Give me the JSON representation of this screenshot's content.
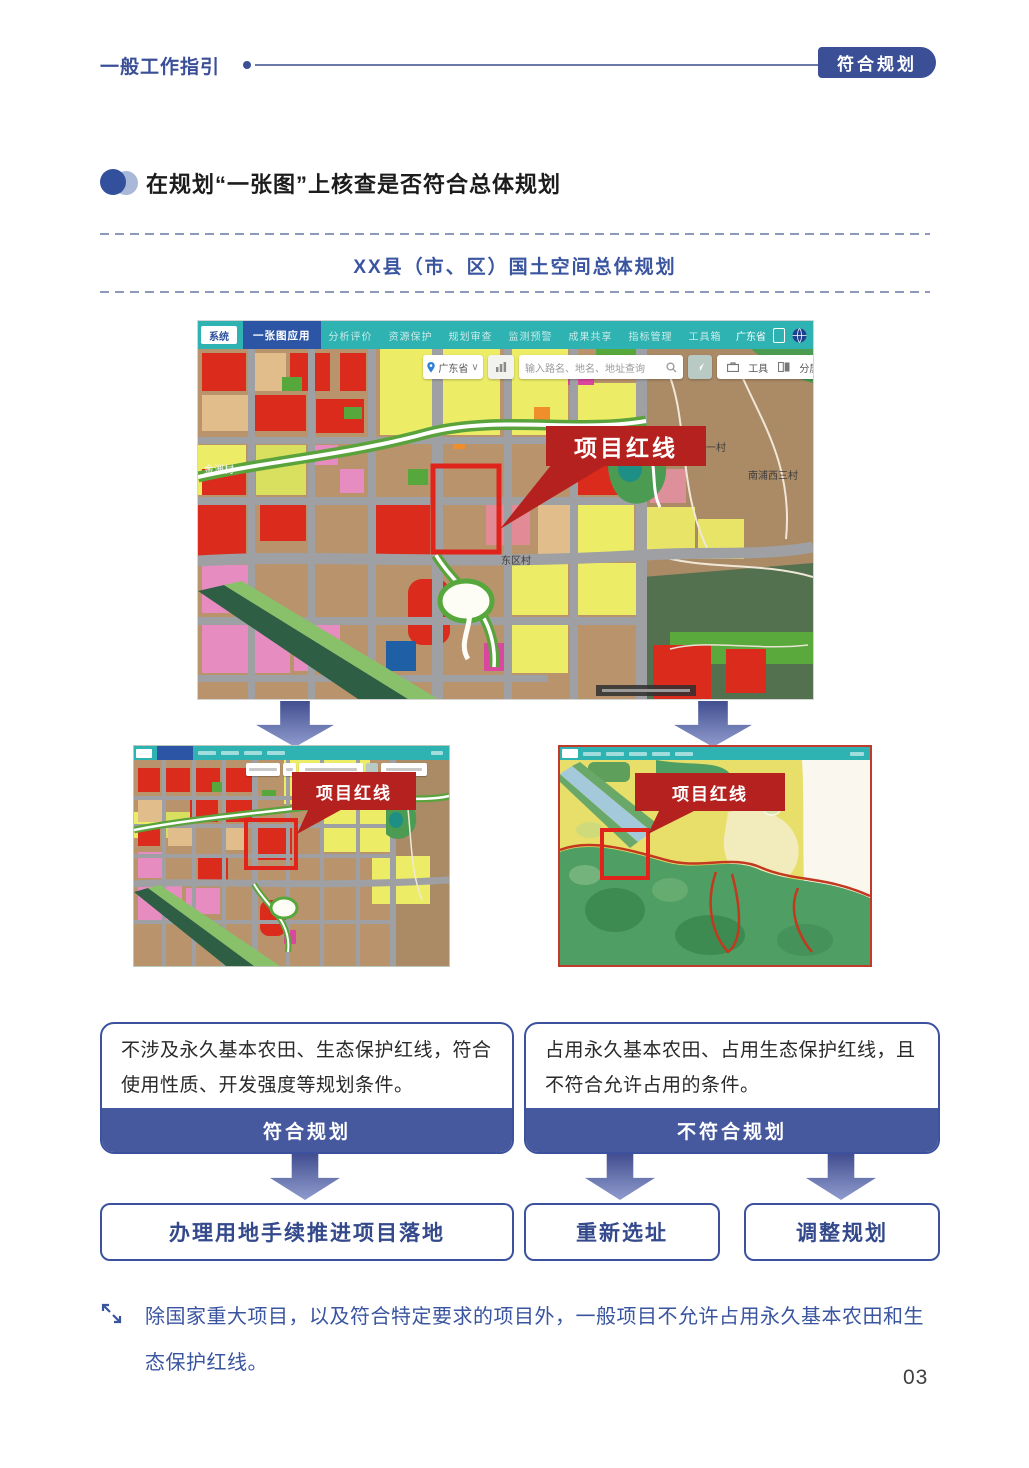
{
  "header": {
    "section_label": "一般工作指引",
    "badge": "符合规划"
  },
  "heading": {
    "title": "在规划“一张图”上核查是否符合总体规划"
  },
  "plan_box": {
    "title": "XX县（市、区）国土空间总体规划"
  },
  "main_map": {
    "logo": "系统",
    "active_tab": "一张图应用",
    "tabs": [
      "分析评价",
      "资源保护",
      "规划审查",
      "监测预警",
      "成果共享",
      "指标管理",
      "工具箱"
    ],
    "toolbar_region": "广东省",
    "search": {
      "region": "广东省",
      "caret": "∨",
      "placeholder": "输入路名、地名、地址查询",
      "tools": "工具",
      "split": "分屏"
    },
    "callout": "项目红线",
    "labels": {
      "west_village": "金洲村",
      "center_village": "东区村",
      "right_village_1": "南浦西一村",
      "right_village_2": "南浦西三村"
    }
  },
  "sub_maps": {
    "left": {
      "callout": "项目红线"
    },
    "right": {
      "callout": "项目红线"
    }
  },
  "decision": {
    "compliant": {
      "text": "不涉及永久基本农田、生态保护红线，符合使用性质、开发强度等规划条件。",
      "banner": "符合规划",
      "action": "办理用地手续推进项目落地"
    },
    "noncompliant": {
      "text": "占用永久基本农田、占用生态保护红线，且不符合允许占用的条件。",
      "banner": "不符合规划",
      "actions": [
        "重新选址",
        "调整规划"
      ]
    }
  },
  "note": {
    "text": "除国家重大项目，以及符合特定要求的项目外，一般项目不允许占用永久基本农田和生态保护红线。"
  },
  "page": {
    "number": "03"
  },
  "colors": {
    "accent_blue": "#3c529e",
    "banner_blue": "#46589e",
    "toolbar_teal": "#2fb3b2",
    "callout_red": "#b5211f",
    "redline_red": "#e0241b"
  }
}
